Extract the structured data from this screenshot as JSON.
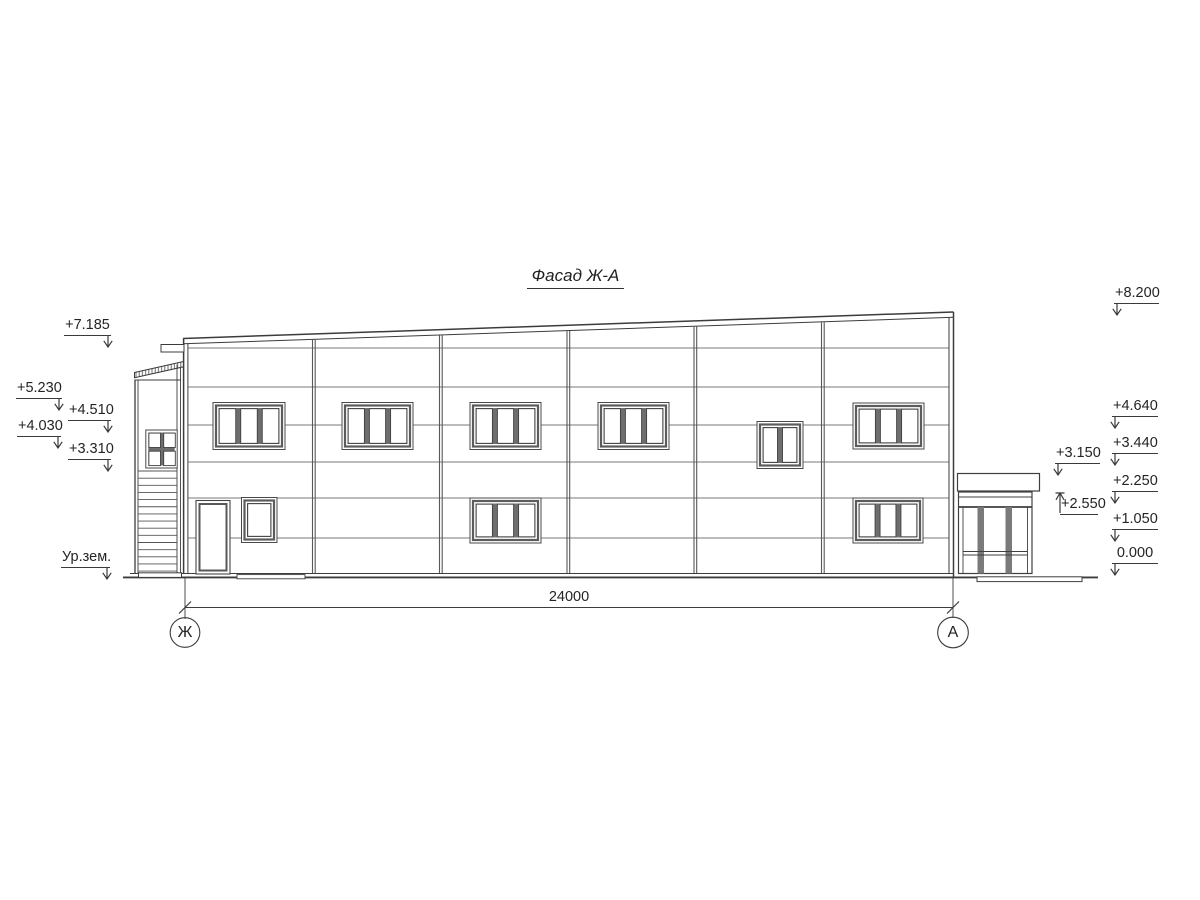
{
  "title": "Фасад Ж-А",
  "dimension": {
    "total_width_mm": "24000"
  },
  "axes": {
    "left_label": "Ж",
    "right_label": "А"
  },
  "marks_left": [
    {
      "value": "+7.185"
    },
    {
      "value": "+5.230"
    },
    {
      "value": "+4.510"
    },
    {
      "value": "+4.030"
    },
    {
      "value": "+3.310"
    },
    {
      "value": "Ур.зем."
    }
  ],
  "marks_right": [
    {
      "value": "+8.200"
    },
    {
      "value": "+4.640"
    },
    {
      "value": "+3.440"
    },
    {
      "value": "+2.250"
    },
    {
      "value": "+1.050"
    },
    {
      "value": "0.000"
    }
  ],
  "marks_annex": [
    {
      "value": "+3.150"
    },
    {
      "value": "+2.550"
    }
  ]
}
